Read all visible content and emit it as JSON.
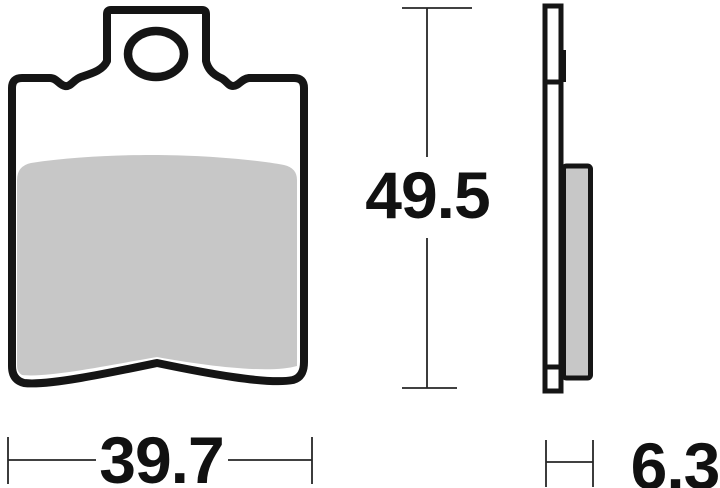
{
  "drawing": {
    "dimensions": {
      "width": {
        "value": "39.7"
      },
      "height": {
        "value": "49.5"
      },
      "thickness": {
        "value": "6.3"
      }
    },
    "colors": {
      "outline": "#151515",
      "friction_material": "#c7c7c7",
      "dimension_line": "#262626",
      "background": "#ffffff",
      "text": "#111111"
    }
  }
}
